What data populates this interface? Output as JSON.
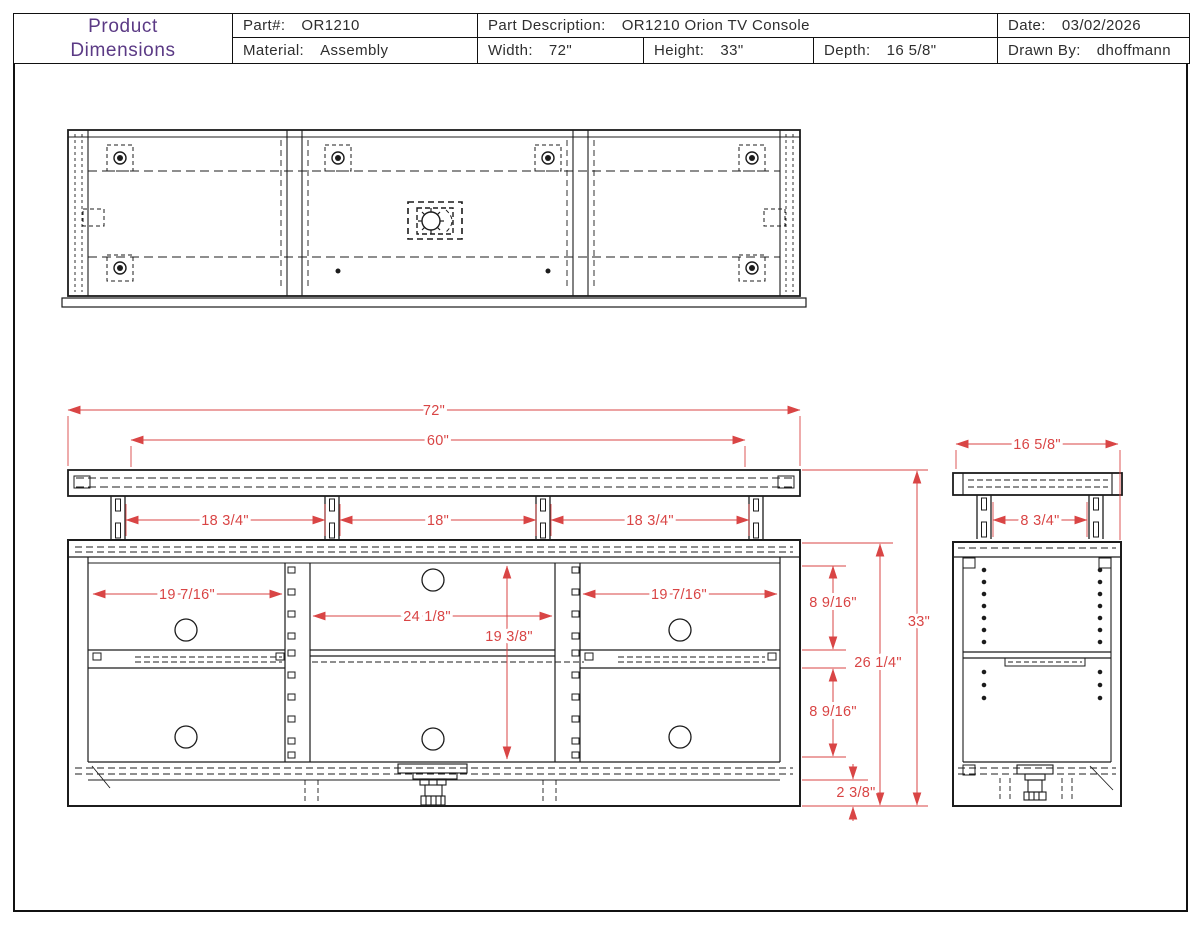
{
  "title_block": {
    "title_line1": "Product",
    "title_line2": "Dimensions",
    "part_label": "Part#:",
    "part_value": "OR1210",
    "material_label": "Material:",
    "material_value": "Assembly",
    "part_desc_label": "Part Description:",
    "part_desc_value": "OR1210 Orion TV Console",
    "width_label": "Width:",
    "width_value": "72\"",
    "height_label": "Height:",
    "height_value": "33\"",
    "depth_label": "Depth:",
    "depth_value": "16 5/8\"",
    "date_label": "Date:",
    "date_value": "03/02/2026",
    "drawn_by_label": "Drawn By:",
    "drawn_by_value": "dhoffmann"
  },
  "colors": {
    "dimension_red": "#d94545",
    "line_black": "#1c1c1c",
    "title_purple": "#5b3a85"
  },
  "dims": {
    "w72": "72\"",
    "w60": "60\"",
    "g1": "18 3/4\"",
    "g2": "18\"",
    "g3": "18 3/4\"",
    "o_left": "19 7/16\"",
    "o_center": "24 1/8\"",
    "o_center_h": "19 3/8\"",
    "o_right": "19 7/16\"",
    "s_top": "8 9/16\"",
    "s_bottom": "8 9/16\"",
    "body_h": "26 1/4\"",
    "total_h": "33\"",
    "base_h": "2 3/8\"",
    "depth": "16 5/8\"",
    "leg_gap_side": "8 3/4\""
  },
  "views": {
    "top_view": "top-plan-view",
    "front_view": "front-elevation-view",
    "side_view": "side-elevation-view"
  }
}
